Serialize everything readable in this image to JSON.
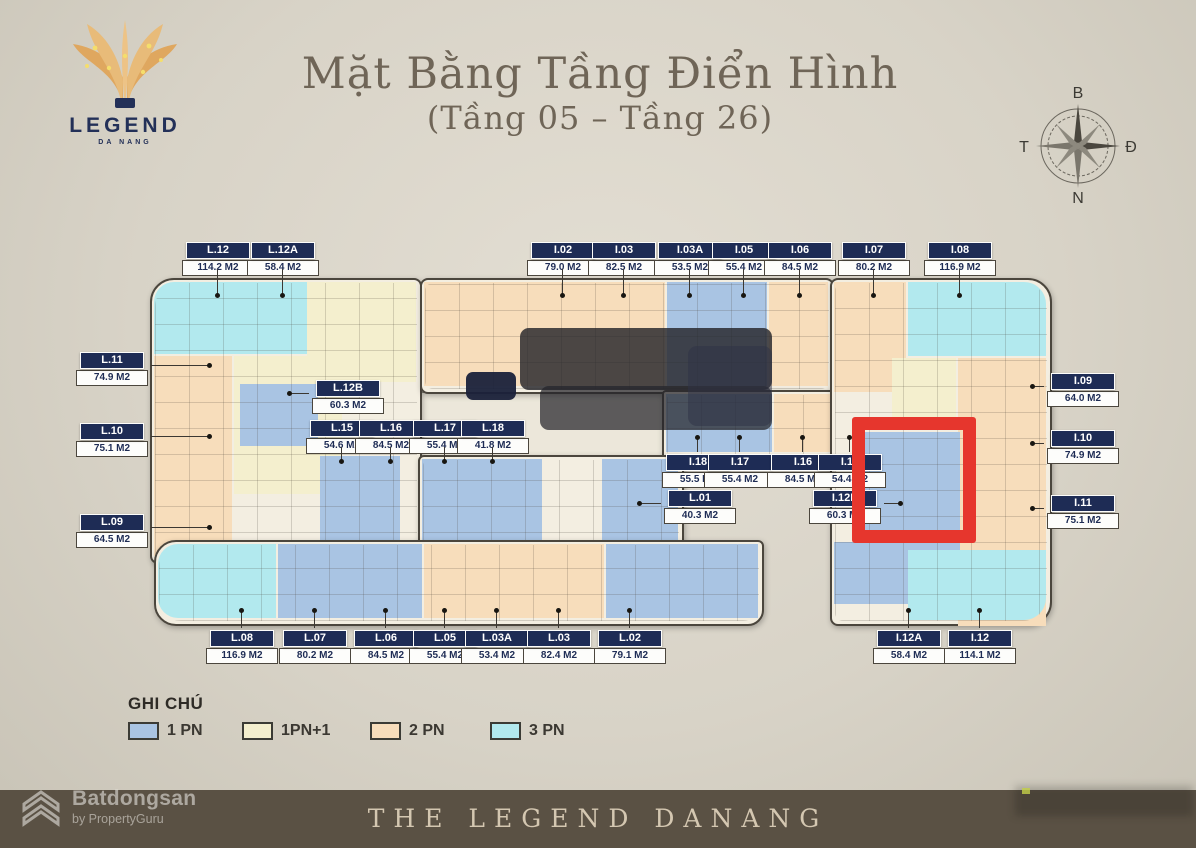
{
  "title": {
    "line1": "Mặt Bằng Tầng Điển Hình",
    "line2": "(Tầng 05 – Tầng 26)"
  },
  "logo": {
    "brand": "LEGEND",
    "sub": "DA NANG"
  },
  "compass": {
    "north": "B",
    "south": "N",
    "west": "T",
    "east": "Đ"
  },
  "units": {
    "top": [
      {
        "id": "L.12",
        "area": "114.2 M2"
      },
      {
        "id": "L.12A",
        "area": "58.4 M2"
      },
      {
        "id": "I.02",
        "area": "79.0 M2"
      },
      {
        "id": "I.03",
        "area": "82.5 M2"
      },
      {
        "id": "I.03A",
        "area": "53.5 M2"
      },
      {
        "id": "I.05",
        "area": "55.4 M2"
      },
      {
        "id": "I.06",
        "area": "84.5 M2"
      },
      {
        "id": "I.07",
        "area": "80.2 M2"
      },
      {
        "id": "I.08",
        "area": "116.9 M2"
      }
    ],
    "left": [
      {
        "id": "L.11",
        "area": "74.9 M2"
      },
      {
        "id": "L.10",
        "area": "75.1 M2"
      },
      {
        "id": "L.09",
        "area": "64.5 M2"
      }
    ],
    "right": [
      {
        "id": "I.09",
        "area": "64.0 M2"
      },
      {
        "id": "I.10",
        "area": "74.9 M2"
      },
      {
        "id": "I.11",
        "area": "75.1 M2"
      }
    ],
    "bottom": [
      {
        "id": "L.08",
        "area": "116.9 M2"
      },
      {
        "id": "L.07",
        "area": "80.2 M2"
      },
      {
        "id": "L.06",
        "area": "84.5 M2"
      },
      {
        "id": "L.05",
        "area": "55.4 M2"
      },
      {
        "id": "L.03A",
        "area": "53.4 M2"
      },
      {
        "id": "L.03",
        "area": "82.4 M2"
      },
      {
        "id": "L.02",
        "area": "79.1 M2"
      },
      {
        "id": "I.12A",
        "area": "58.4 M2"
      },
      {
        "id": "I.12",
        "area": "114.1 M2"
      }
    ],
    "inner": [
      {
        "id": "L.12B",
        "area": "60.3 M2"
      },
      {
        "id": "L.15",
        "area": "54.6 M2"
      },
      {
        "id": "L.16",
        "area": "84.5 M2"
      },
      {
        "id": "L.17",
        "area": "55.4 M2"
      },
      {
        "id": "L.18",
        "area": "41.8 M2"
      },
      {
        "id": "I.18",
        "area": "55.5 M2"
      },
      {
        "id": "I.17",
        "area": "55.4 M2"
      },
      {
        "id": "I.16",
        "area": "84.5 M2"
      },
      {
        "id": "I.15",
        "area": "54.4 M2"
      },
      {
        "id": "L.01",
        "area": "40.3 M2"
      },
      {
        "id": "I.12B",
        "area": "60.3 M2"
      }
    ]
  },
  "legend": {
    "heading": "GHI CHÚ",
    "items": [
      {
        "label": "1 PN",
        "color": "#a9c4e3"
      },
      {
        "label": "1PN+1",
        "color": "#f4efce"
      },
      {
        "label": "2 PN",
        "color": "#f7ddbb"
      },
      {
        "label": "3 PN",
        "color": "#b2e9ee"
      }
    ]
  },
  "footer": {
    "brand": "THE LEGEND DANANG"
  },
  "watermark": {
    "name": "Batdongsan",
    "byline": "by PropertyGuru"
  },
  "colors": {
    "highlight": "#e6362d",
    "label_bg": "#1e2c55",
    "footer_bg": "#5a5144"
  }
}
